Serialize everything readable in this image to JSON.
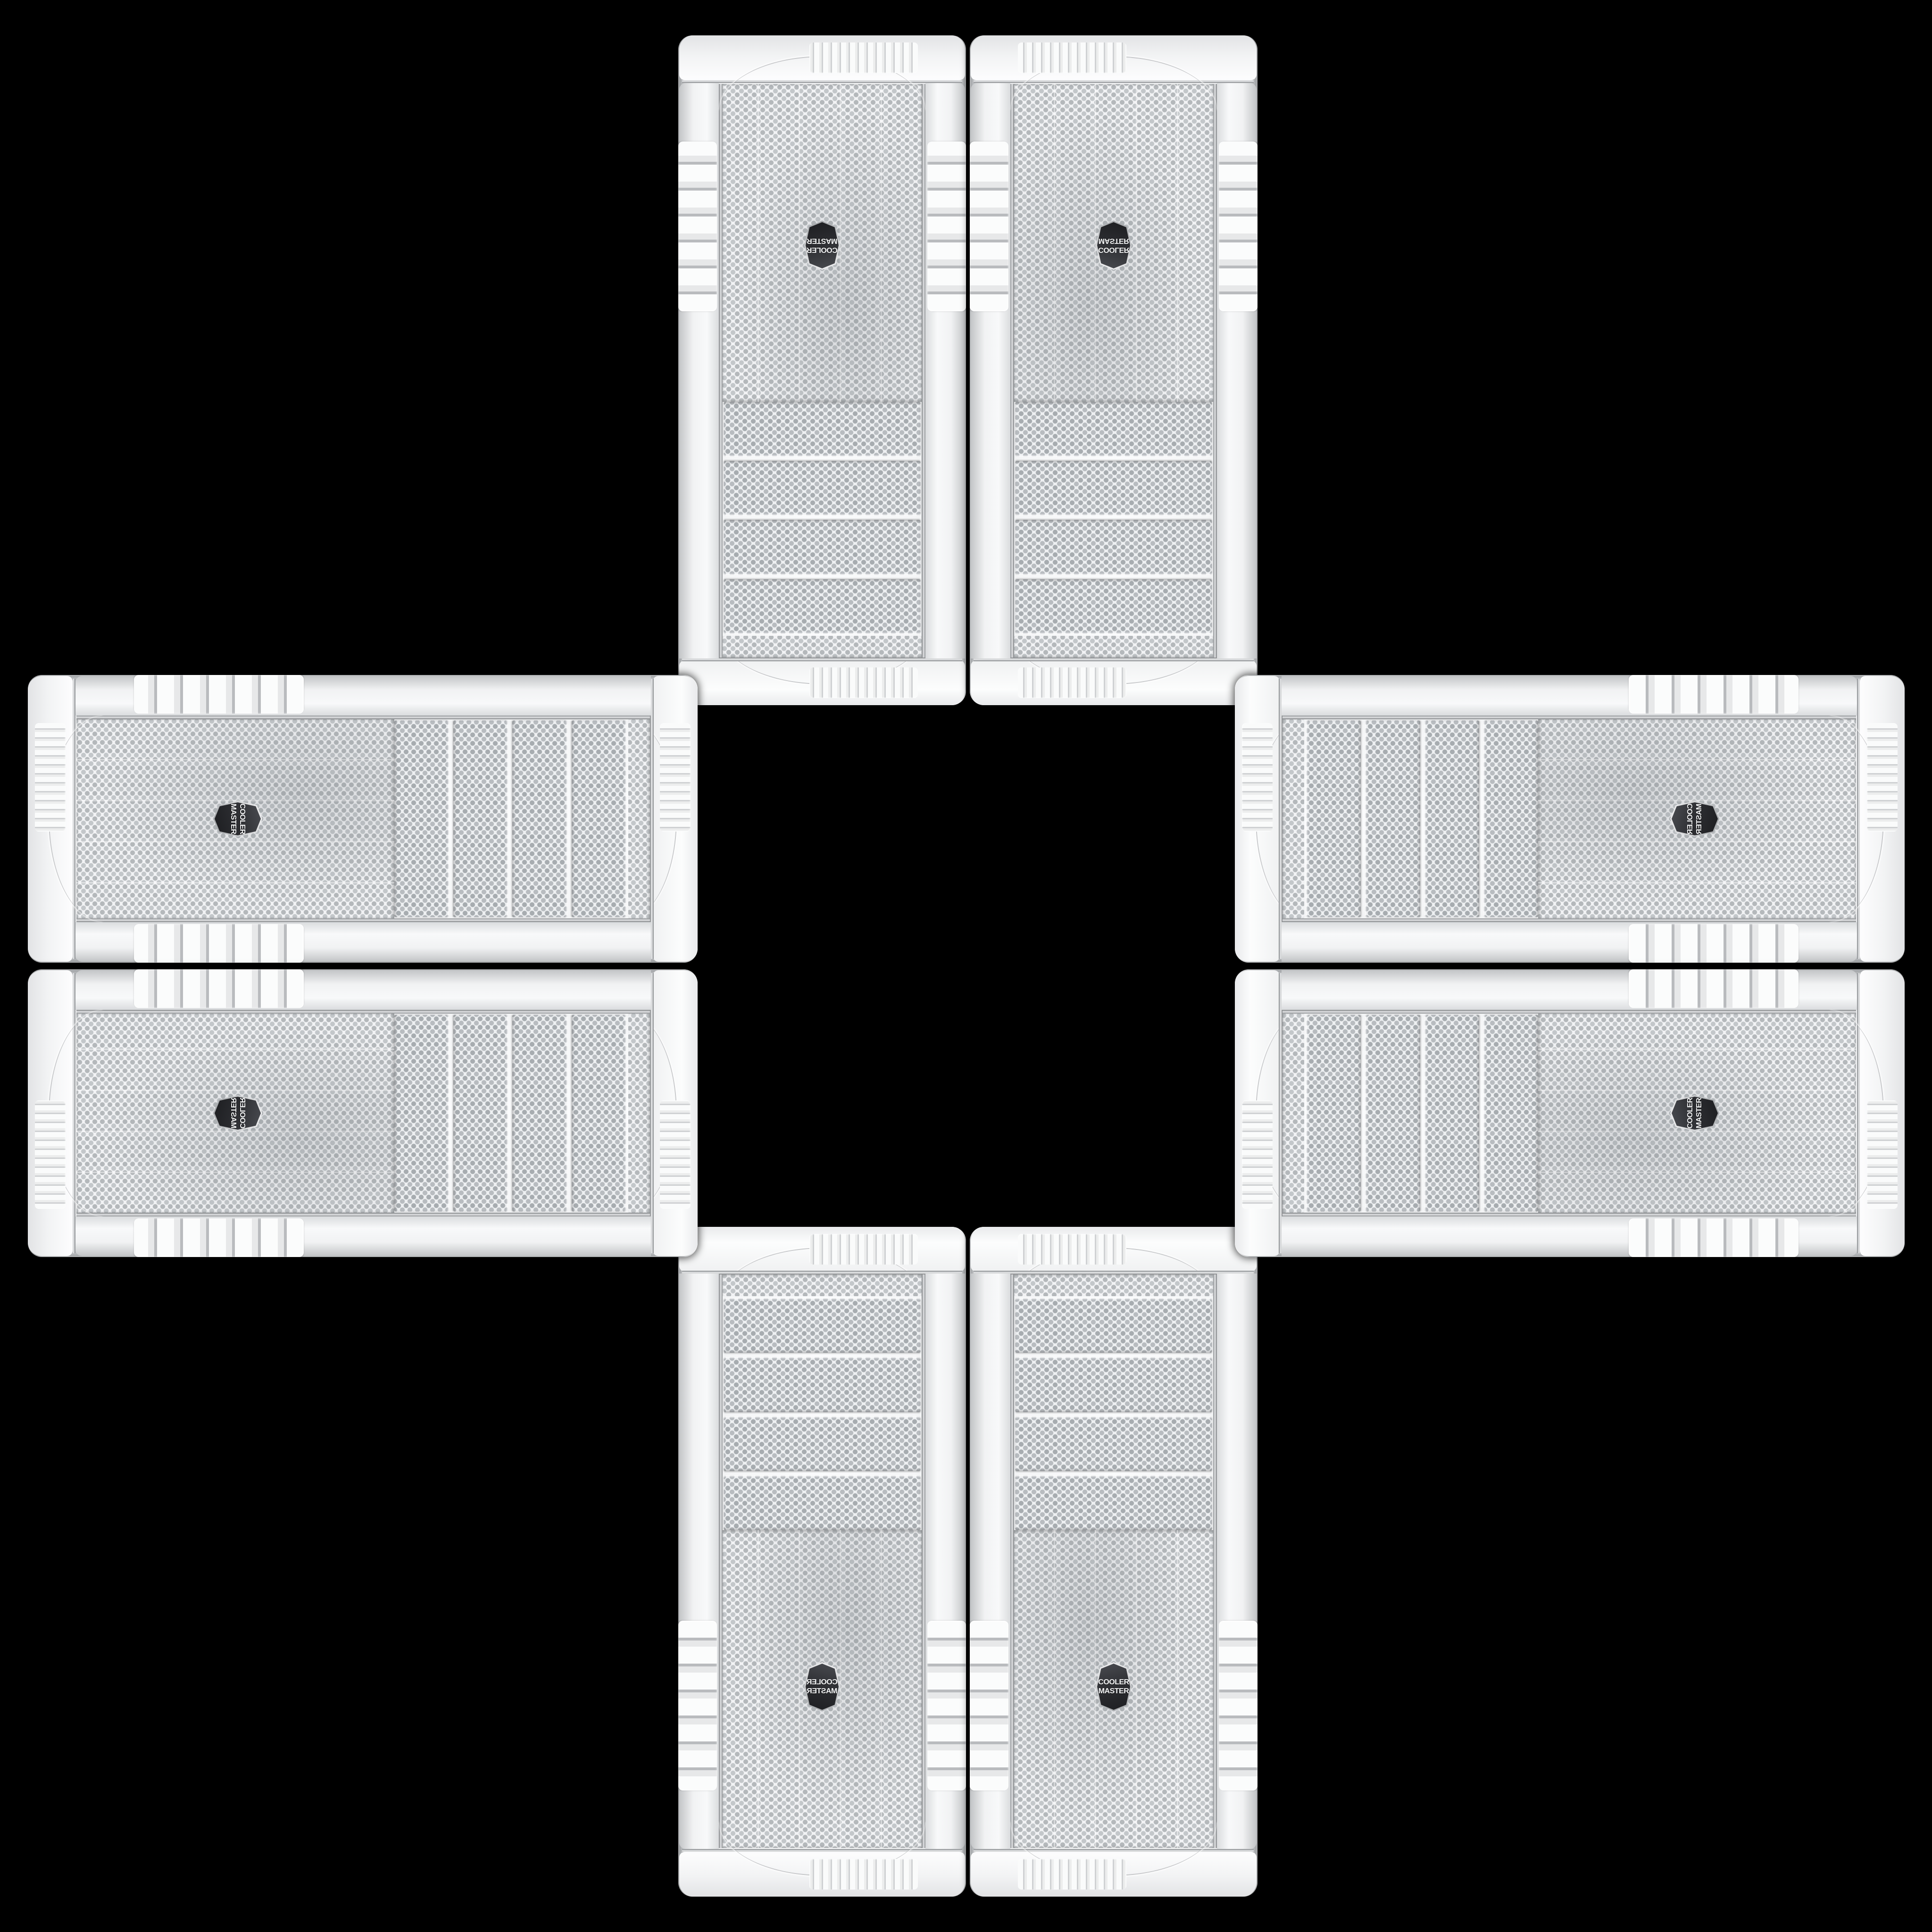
{
  "scene": {
    "background_color": "#000000",
    "description": "Eight identical white Cooler Master tower-case front panels arranged in a cross / plus pattern on a black background, shown in mirrored and rotated orientations",
    "case_count": 8
  },
  "badge": {
    "line1": "COOLER",
    "line2": "MASTER",
    "background_color": "#2b2c30",
    "text_color": "#f4f5f6"
  },
  "case": {
    "body_color": "#f5f6f7",
    "mesh_base_color": "#f2f3f5",
    "mesh_dot_color": "#b4b8bb",
    "chrome_color": "#d8dadc",
    "drive_bay_count": 4,
    "fin_vent_side": "both side trims",
    "cap_vent": "ridged vent group on top and bottom bezels"
  },
  "cases": [
    {
      "id": "case-top-left",
      "orientation": "rotated-180"
    },
    {
      "id": "case-top-right",
      "orientation": "flipped-vertical"
    },
    {
      "id": "case-bottom-left",
      "orientation": "mirrored-horizontal"
    },
    {
      "id": "case-bottom-right",
      "orientation": "original"
    },
    {
      "id": "case-left-top",
      "orientation": "rotated-90-cw"
    },
    {
      "id": "case-left-bottom",
      "orientation": "rotated-90-cw-flipped"
    },
    {
      "id": "case-right-top",
      "orientation": "rotated-90-ccw-flipped"
    },
    {
      "id": "case-right-bottom",
      "orientation": "rotated-90-ccw"
    }
  ]
}
